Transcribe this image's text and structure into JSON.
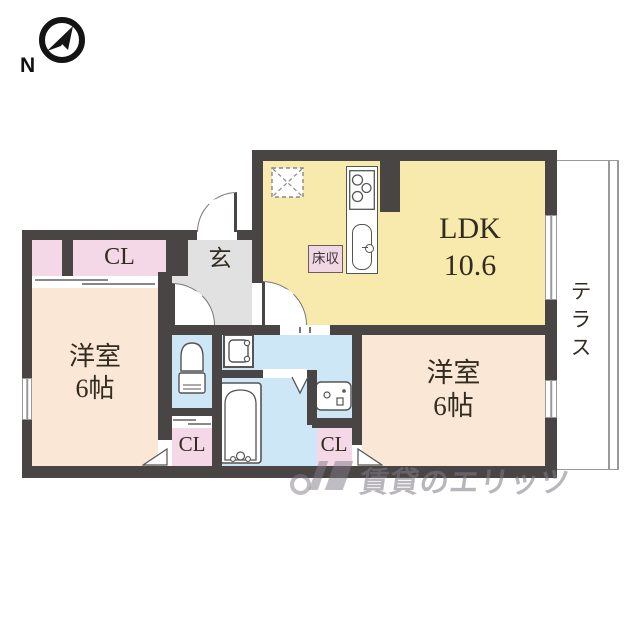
{
  "compass": {
    "label": "N"
  },
  "floorplan": {
    "ldk": {
      "name": "LDK",
      "area": "10.6"
    },
    "floor_storage": {
      "label": "床収"
    },
    "genkan": {
      "label": "玄"
    },
    "entry_closet": {
      "label": "CL"
    },
    "bedroom_left": {
      "name": "洋室",
      "area": "6帖"
    },
    "bedroom_right": {
      "name": "洋室",
      "area": "6帖"
    },
    "closet_bottom_left": {
      "label": "CL"
    },
    "closet_bottom_right": {
      "label": "CL"
    },
    "terrace": {
      "label": "テラス"
    }
  },
  "watermark": {
    "text": "賃貸のエリッツ"
  },
  "colors": {
    "wall": "#4a4545",
    "ldk_fill": "#f8e9ad",
    "bedroom_fill": "#fbe7d5",
    "closet_fill": "#f5d8e7",
    "hall_fill": "#e2e1e1",
    "wet_area_fill": "#cde7f6",
    "floor_storage_fill": "#efd7e3",
    "watermark_color": "#807986"
  }
}
